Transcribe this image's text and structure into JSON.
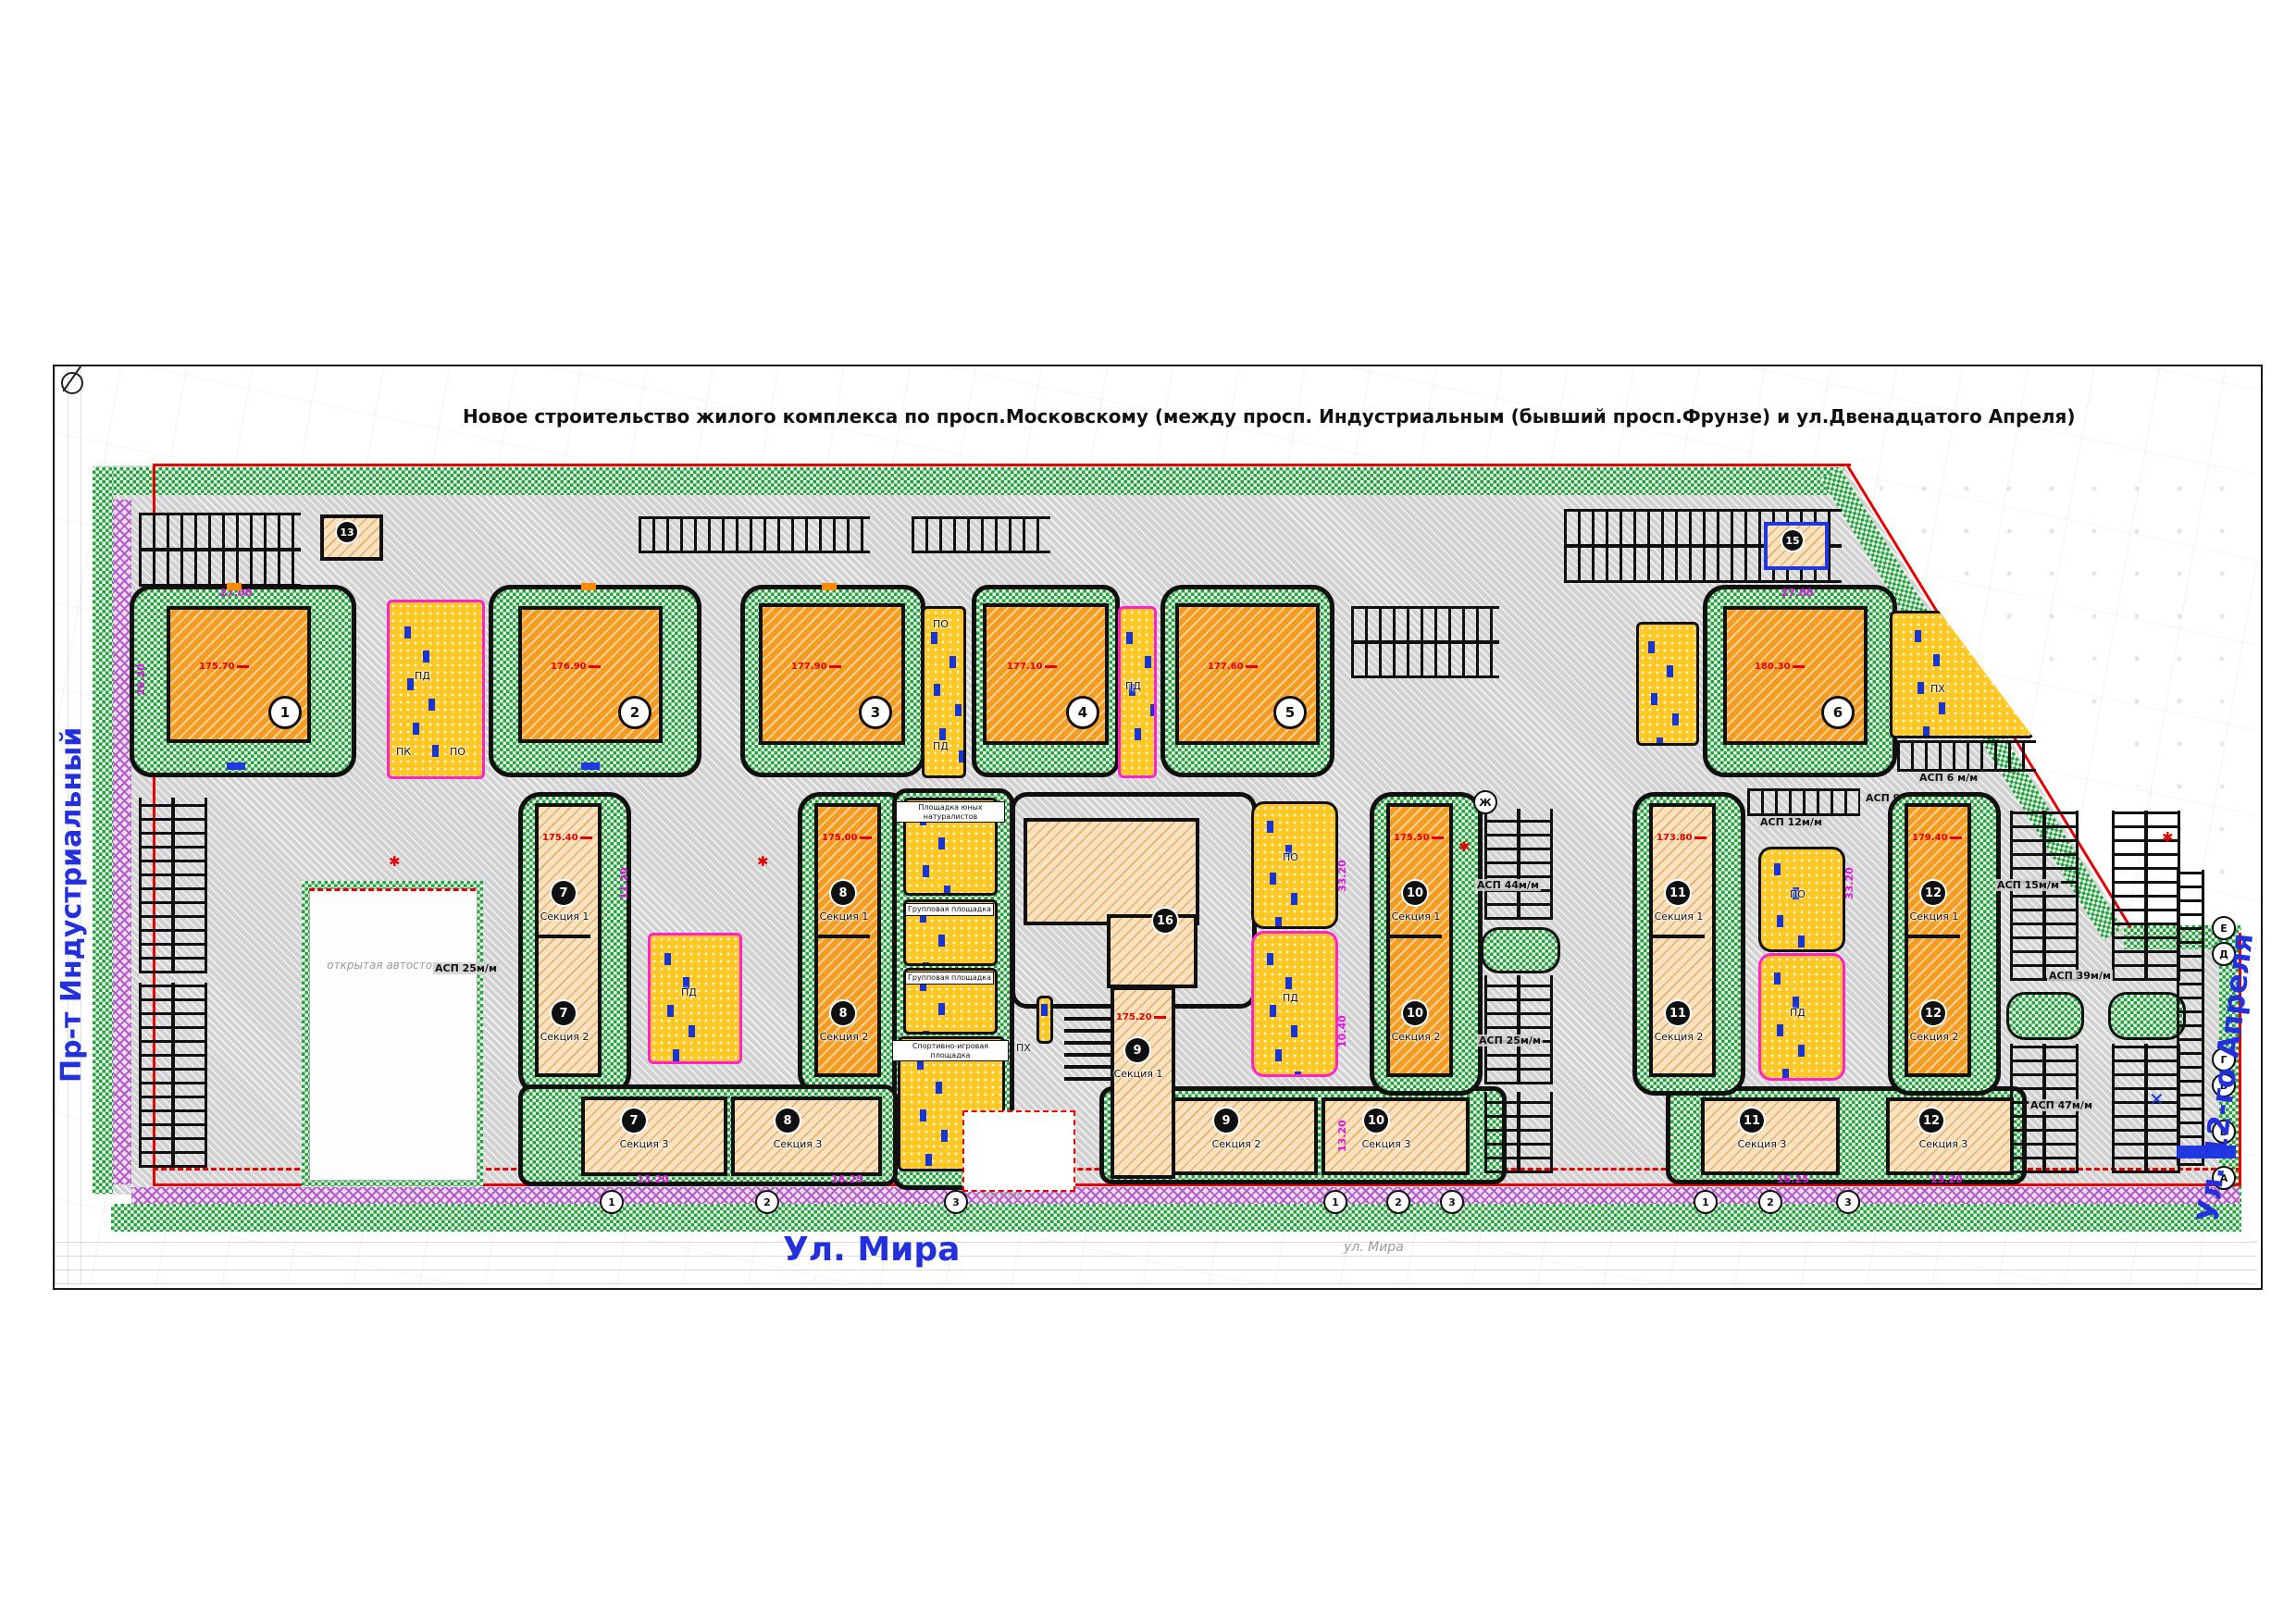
{
  "title": "Новое строительство жилого комплекса по просп.Московскому (между просп. Индустриальным (бывший просп.Фрунзе)   и ул.Двенадцатого Апреля)",
  "streets": {
    "left": "Пр-т Индустриальный",
    "bottom": "Ул. Мира",
    "bottom_small": "ул. Мира",
    "right": "Ул. 12-го Апреля"
  },
  "towers": [
    {
      "num": "1",
      "elev": "175.70"
    },
    {
      "num": "2",
      "elev": "176.90"
    },
    {
      "num": "3",
      "elev": "177.90"
    },
    {
      "num": "4",
      "elev": "177.10"
    },
    {
      "num": "5",
      "elev": "177.60"
    },
    {
      "num": "6",
      "elev": "180.30"
    }
  ],
  "clusters": [
    {
      "num": "7",
      "elev": "175.40"
    },
    {
      "num": "8",
      "elev": "175.00"
    },
    {
      "num": "9",
      "elev": "175.20"
    },
    {
      "num": "10",
      "elev": "175.50"
    },
    {
      "num": "11",
      "elev": "173.80"
    },
    {
      "num": "12",
      "elev": "179.40"
    }
  ],
  "labels": {
    "sec1": "Секция 1",
    "sec2": "Секция 2",
    "sec3": "Секция 3"
  },
  "small_buildings": {
    "tp_left": "13",
    "tp_right": "15",
    "center": "16"
  },
  "playgrounds": {
    "naturalists": "Площадка юных натуралистов",
    "group": "Групповая площадка",
    "sport": "Спортивно-игровая площадка",
    "pd": "ПД",
    "po": "ПО",
    "pk": "ПК",
    "ph": "ПХ"
  },
  "parking": {
    "p25": "АСП 25м/м",
    "p44": "АСП 44м/м",
    "p12": "АСП 12м/м",
    "p9": "АСП 9м/м",
    "p15": "АСП 15м/м",
    "p39": "АСП 39м/м",
    "p47": "АСП 47м/м",
    "p6": "АСП 6 м/м",
    "open_lot": "открытая автостоянка",
    "shop": "магазин"
  },
  "dims": {
    "d27": "27.00",
    "d2620": "26.20",
    "d3320": "33.20",
    "d1120": "11.20",
    "d1040": "10.40",
    "d1320": "13.20",
    "d1625": "16.25"
  },
  "axes": {
    "zh": "Ж",
    "e": "Е",
    "d": "Д",
    "g": "Г",
    "v": "В",
    "b": "Б",
    "a": "А",
    "n1": "1",
    "n2": "2",
    "n3": "3"
  },
  "colors": {
    "lawn": "#21a33c",
    "paving": "#d2d2d2",
    "building_new": "#f49d22",
    "building_sections": "#f8e2c0",
    "playground": "#ffc824",
    "boundary_red": "#e80000",
    "street_blue": "#2230dd",
    "dimension_magenta": "#e014e0",
    "equipment_blue": "#1535d8",
    "sidewalk_purple": "#b35cc9"
  }
}
